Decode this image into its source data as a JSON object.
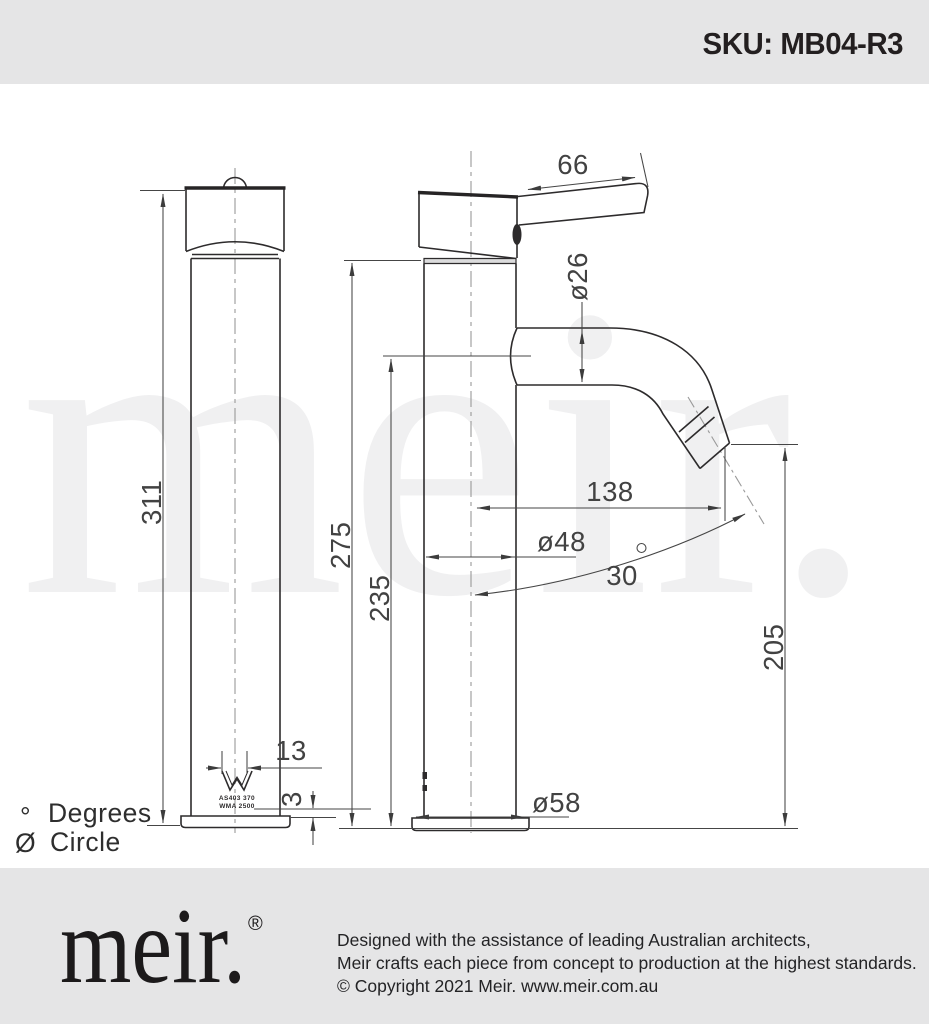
{
  "header": {
    "sku": "SKU: MB04-R3"
  },
  "watermark": "meir.",
  "drawing": {
    "dims": {
      "handle_length": "66",
      "spout_tube_diameter": "ø26",
      "overall_height": "311",
      "height_under_head": "275",
      "spout_centre_height": "235",
      "spout_reach": "138",
      "body_diameter": "ø48",
      "spout_angle": "30",
      "spout_angle_unit": "°",
      "outlet_height": "205",
      "base_detail_width": "13",
      "base_plate_height": "3",
      "base_diameter": "ø58"
    },
    "cert": {
      "line1": "AS403 370",
      "line2": "WMA 2500"
    },
    "legend": {
      "degrees_symbol": "°",
      "degrees_label": "Degrees",
      "circle_symbol": "Ø",
      "circle_label": "Circle"
    }
  },
  "footer": {
    "logo": "meir.",
    "registered": "®",
    "lines": [
      "Designed with the assistance of leading Australian architects,",
      "Meir crafts each piece from concept to production at the highest standards.",
      "© Copyright 2021 Meir. www.meir.com.au"
    ]
  }
}
